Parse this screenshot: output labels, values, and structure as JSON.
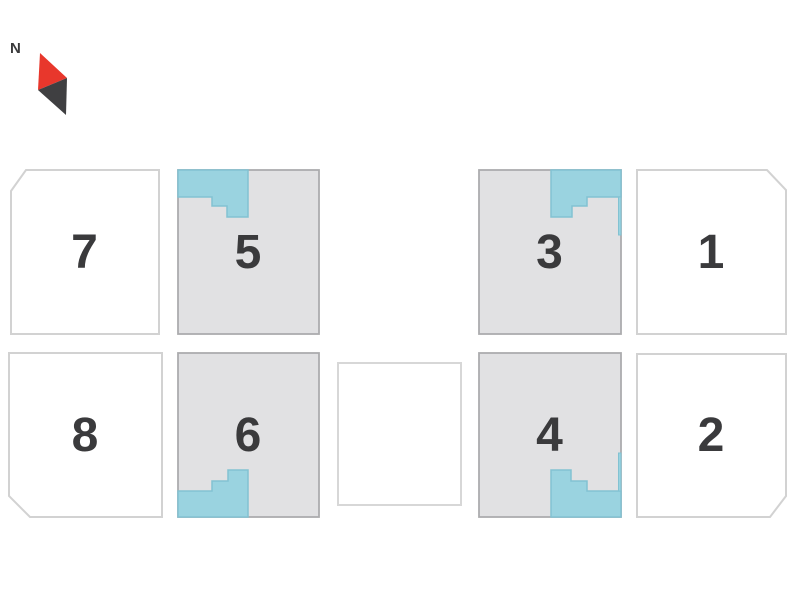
{
  "compass": {
    "label": "N"
  },
  "units": [
    {
      "label": "7",
      "status": "available"
    },
    {
      "label": "5",
      "status": "taken"
    },
    {
      "label": "3",
      "status": "taken"
    },
    {
      "label": "1",
      "status": "available"
    },
    {
      "label": "8",
      "status": "available"
    },
    {
      "label": "6",
      "status": "taken"
    },
    {
      "label": "",
      "status": "blank"
    },
    {
      "label": "4",
      "status": "taken"
    },
    {
      "label": "2",
      "status": "available"
    }
  ],
  "colors": {
    "unit-fill-available": "#ffffff",
    "unit-fill-taken": "#e1e1e3",
    "unit-border-light": "#d2d2d2",
    "unit-border-gray": "#acacae",
    "teal": "#9ad3e0",
    "teal-border": "#82c2d2",
    "number": "#3a3a3c",
    "compass-red": "#e8372c",
    "compass-dark": "#3f3f41"
  }
}
